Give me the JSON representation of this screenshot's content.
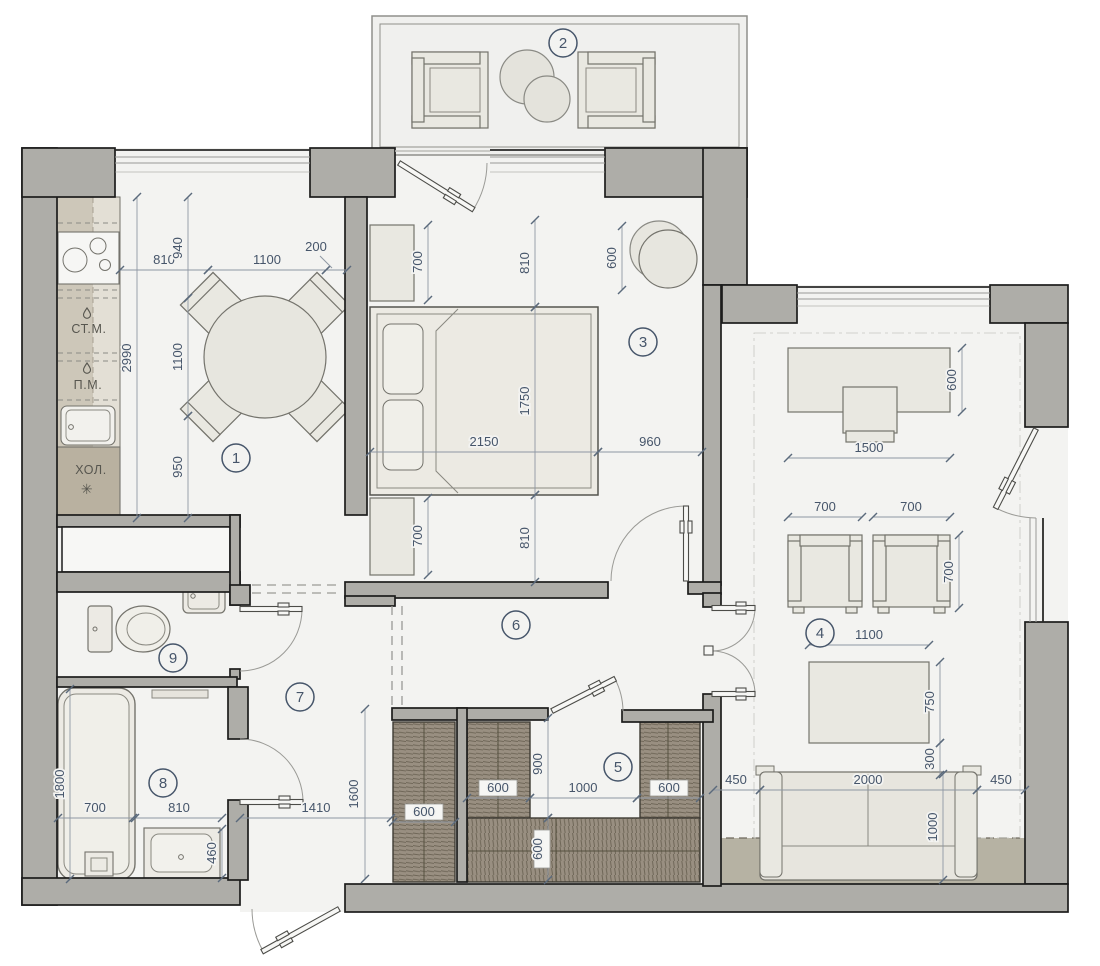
{
  "title": "apartment-floor-plan",
  "rooms": [
    {
      "number": "1"
    },
    {
      "number": "2"
    },
    {
      "number": "3"
    },
    {
      "number": "4"
    },
    {
      "number": "5"
    },
    {
      "number": "6"
    },
    {
      "number": "7"
    },
    {
      "number": "8"
    },
    {
      "number": "9"
    }
  ],
  "kitchen": {
    "washing_machine": "СТ.М.",
    "dishwasher": "П.М.",
    "fridge": "ХОЛ.",
    "fridge_star": "✳"
  },
  "dims": {
    "k_810": "810",
    "k_1100_top": "1100",
    "k_200": "200",
    "k_940": "940",
    "k_1100_v": "1100",
    "k_950": "950",
    "k_2990": "2990",
    "b_700_t": "700",
    "b_810_t": "810",
    "b_600_pouf": "600",
    "b_1750": "1750",
    "b_2150": "2150",
    "b_960": "960",
    "b_700_b": "700",
    "b_810_b": "810",
    "l_600_desk": "600",
    "l_1500": "1500",
    "l_700_a": "700",
    "l_700_b": "700",
    "l_700_v": "700",
    "l_1100": "1100",
    "l_750": "750",
    "l_300": "300",
    "l_450_l": "450",
    "l_2000": "2000",
    "l_450_r": "450",
    "l_1000_sofa": "1000",
    "w_600_a": "600",
    "w_600_b": "600",
    "w_1000": "1000",
    "w_600_c": "600",
    "w_900": "900",
    "w_600_d": "600",
    "h_1410": "1410",
    "h_1600": "1600",
    "bath_1800": "1800",
    "bath_700": "700",
    "bath_810": "810",
    "bath_460": "460"
  },
  "colors": {
    "wall": "#aeada8",
    "floor": "#f3f3f1",
    "dimension_text": "#46556a",
    "wardrobe_hatch": "#998f81",
    "floor_band": "#b6b2a3"
  }
}
